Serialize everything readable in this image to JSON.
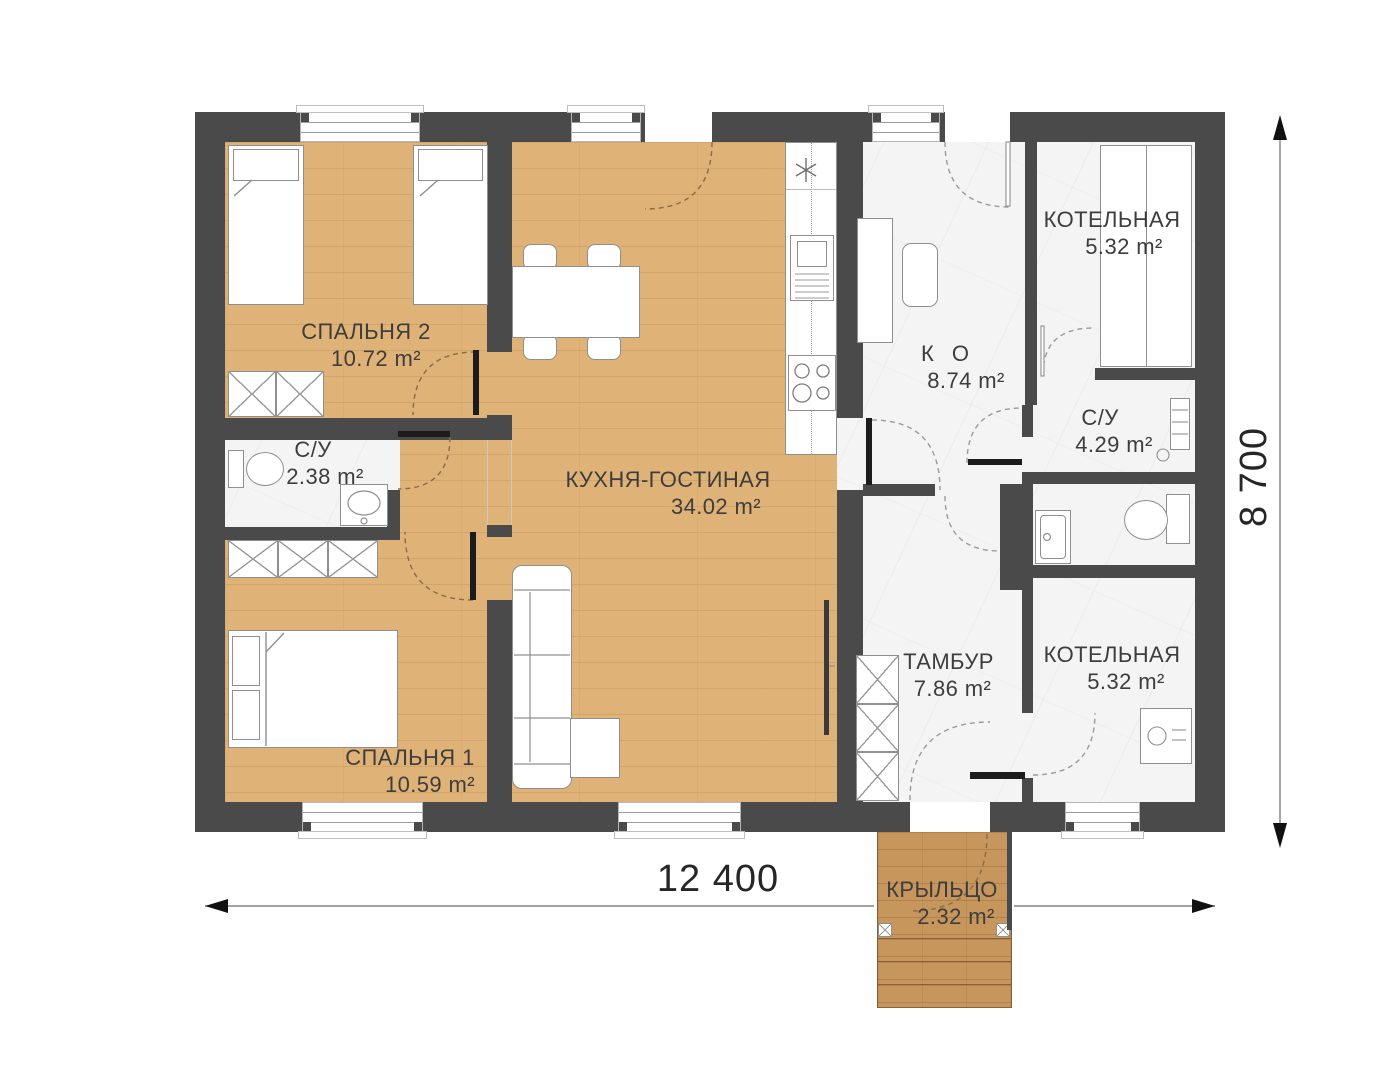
{
  "plan_title": "floor-plan",
  "rooms": {
    "bedroom2": {
      "name": "СПАЛЬНЯ 2",
      "area": "10.72 m²"
    },
    "bathroom_small": {
      "name": "С/У",
      "area": "2.38 m²"
    },
    "bedroom1": {
      "name": "СПАЛЬНЯ 1",
      "area": "10.59 m²"
    },
    "kitchen_living": {
      "name": "КУХНЯ-ГОСТИНАЯ",
      "area": "34.02 m²"
    },
    "corridor": {
      "name": "К О",
      "area": "8.74 m²"
    },
    "boiler_top": {
      "name": "КОТЕЛЬНАЯ",
      "area": "5.32 m²"
    },
    "bathroom_right": {
      "name": "С/У",
      "area": "4.29 m²"
    },
    "tambour": {
      "name": "ТАМБУР",
      "area": "7.86 m²"
    },
    "boiler_bottom": {
      "name": "КОТЕЛЬНАЯ",
      "area": "5.32 m²"
    },
    "porch": {
      "name": "КРЫЛЬЦО",
      "area": "2.32 m²"
    }
  },
  "dimensions": {
    "width_label": "12 400",
    "height_label": "8 700"
  },
  "colors": {
    "wall": "#4a4a4a",
    "wood_floor": "#dfb278",
    "porch_wood": "#c6965c",
    "marble_floor": "#f4f4f4",
    "label_text": "#3d3d3d",
    "dimension_text": "#262626",
    "door_leaf": "#1c1c1c"
  }
}
